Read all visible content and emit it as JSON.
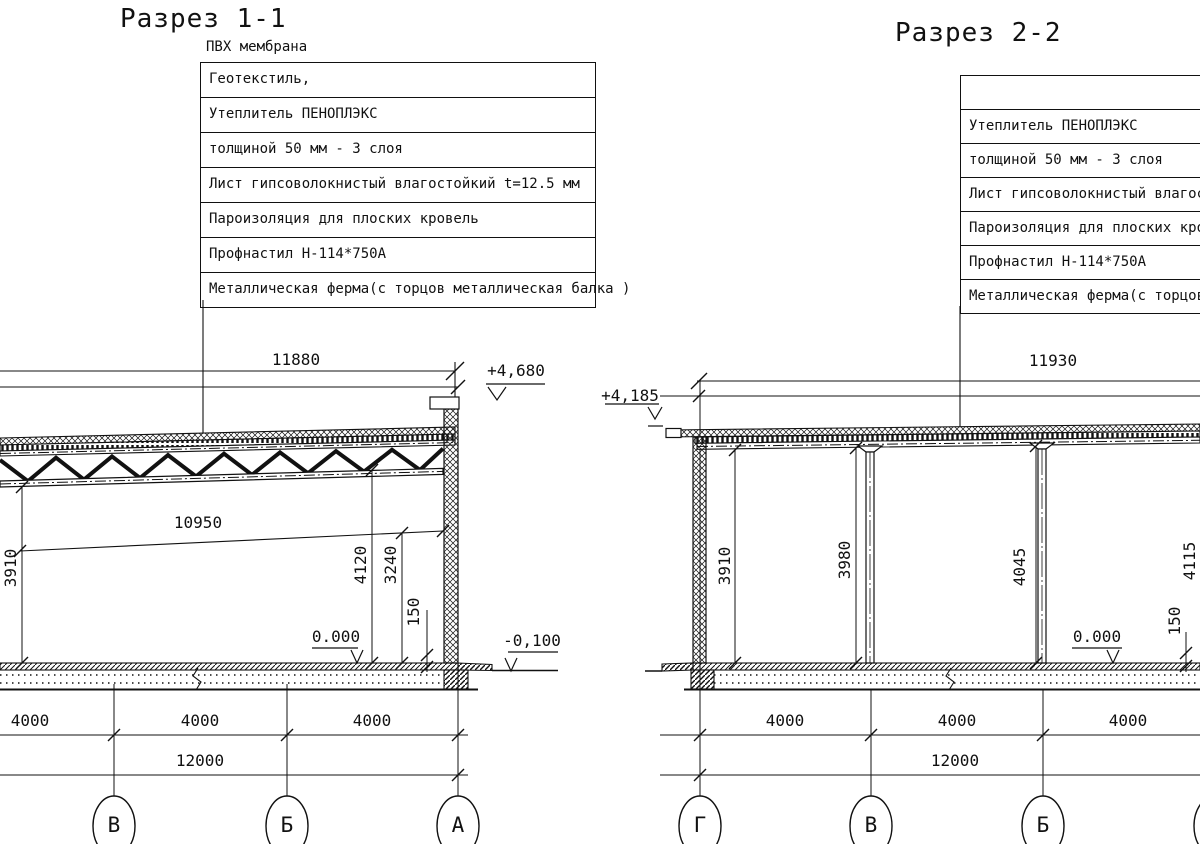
{
  "section1": {
    "title": "Разрез 1-1",
    "membrane": "ПВХ мембрана",
    "callouts": [
      "Геотекстиль,",
      "Утеплитель ПЕНОПЛЭКС",
      "толщиной 50 мм - 3 слоя",
      "Лист гипсоволокнистый влагостойкий t=12.5 мм",
      "Пароизоляция для плоских кровель",
      "Профнастил Н-114*750А",
      "Металлическая ферма(с торцов металлическая балка )"
    ],
    "dims": {
      "top_span": "11880",
      "truss_span": "10950",
      "h_left": "3910",
      "h_mid": "4120",
      "h_right": "3240",
      "slab": "150"
    },
    "levels": {
      "roof": "+4,680",
      "zero": "0.000",
      "grade": "-0,100"
    },
    "bottom_dims": [
      "4000",
      "4000",
      "4000"
    ],
    "total_dim": "12000",
    "axes": [
      "В",
      "Б",
      "А"
    ]
  },
  "section2": {
    "title": "Разрез 2-2",
    "callouts": [
      "",
      "Утеплитель ПЕНОПЛЭКС",
      "толщиной 50 мм - 3 слоя",
      "Лист гипсоволокнистый влагостойкий t=12.5 мм",
      "Пароизоляция для плоских кровель",
      "Профнастил Н-114*750А",
      "Металлическая ферма(с торцов металлическая балка )"
    ],
    "dims": {
      "top_span": "11930",
      "h1": "3910",
      "h2": "3980",
      "h3": "4045",
      "h4": "4115",
      "slab": "150"
    },
    "levels": {
      "roof": "+4,185",
      "zero": "0.000"
    },
    "bottom_dims": [
      "4000",
      "4000",
      "4000"
    ],
    "total_dim": "12000",
    "axes": [
      "Г",
      "В",
      "Б",
      "А"
    ]
  }
}
